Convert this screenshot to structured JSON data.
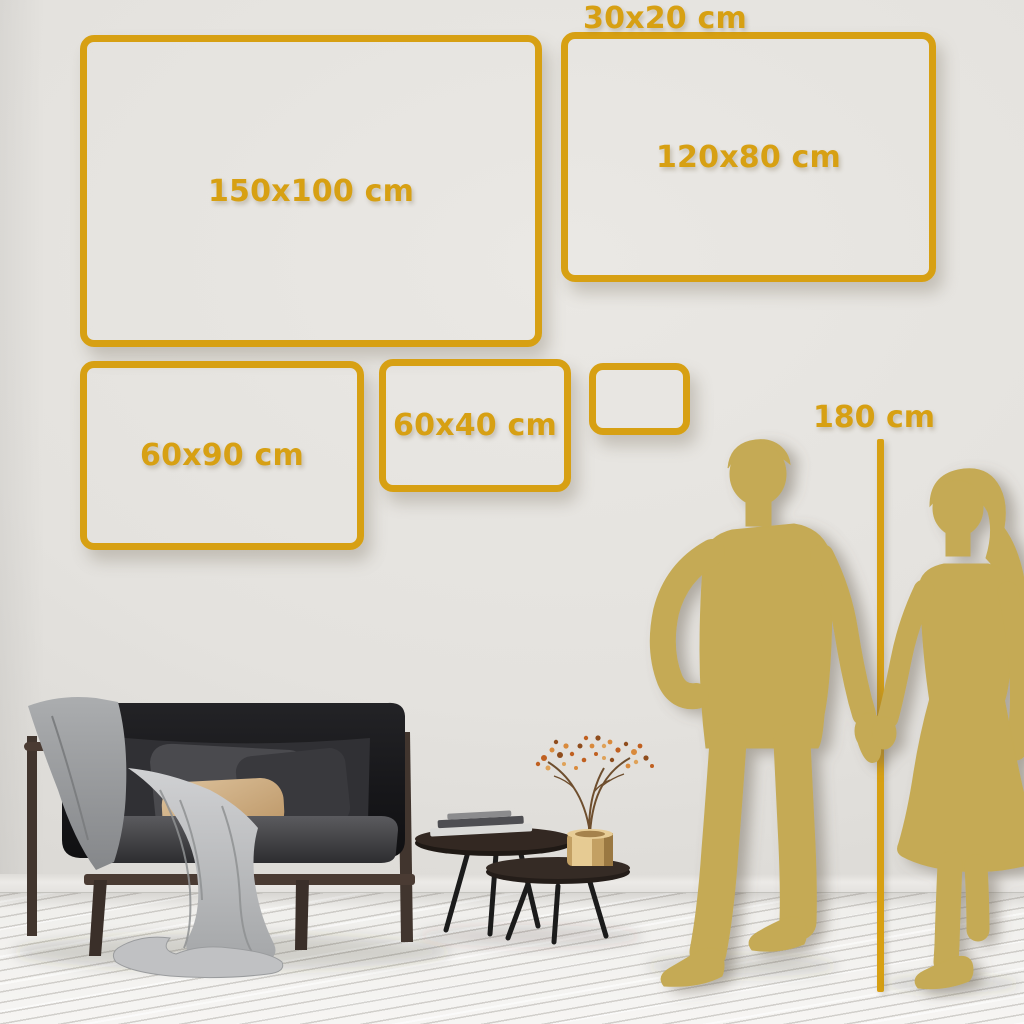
{
  "colors": {
    "accent_gold": "#D7A013",
    "silhouette_gold": "#C5AA54",
    "wall": "#E3E1DD",
    "floor": "#F3F2F0"
  },
  "size_frames": [
    {
      "id": "150x100",
      "label": "150x100 cm"
    },
    {
      "id": "120x80",
      "label": "120x80 cm"
    },
    {
      "id": "60x90",
      "label": "60x90 cm"
    },
    {
      "id": "60x40",
      "label": "60x40 cm"
    },
    {
      "id": "30x20",
      "label": "30x20 cm"
    }
  ],
  "height_marker": {
    "label": "180 cm"
  },
  "scene_objects": [
    "couple-silhouette",
    "height-ruler-line",
    "sofa-with-throw-blanket",
    "pillows",
    "nesting-coffee-tables",
    "books",
    "brass-vase-with-dried-branch",
    "wood-plank-floor"
  ]
}
